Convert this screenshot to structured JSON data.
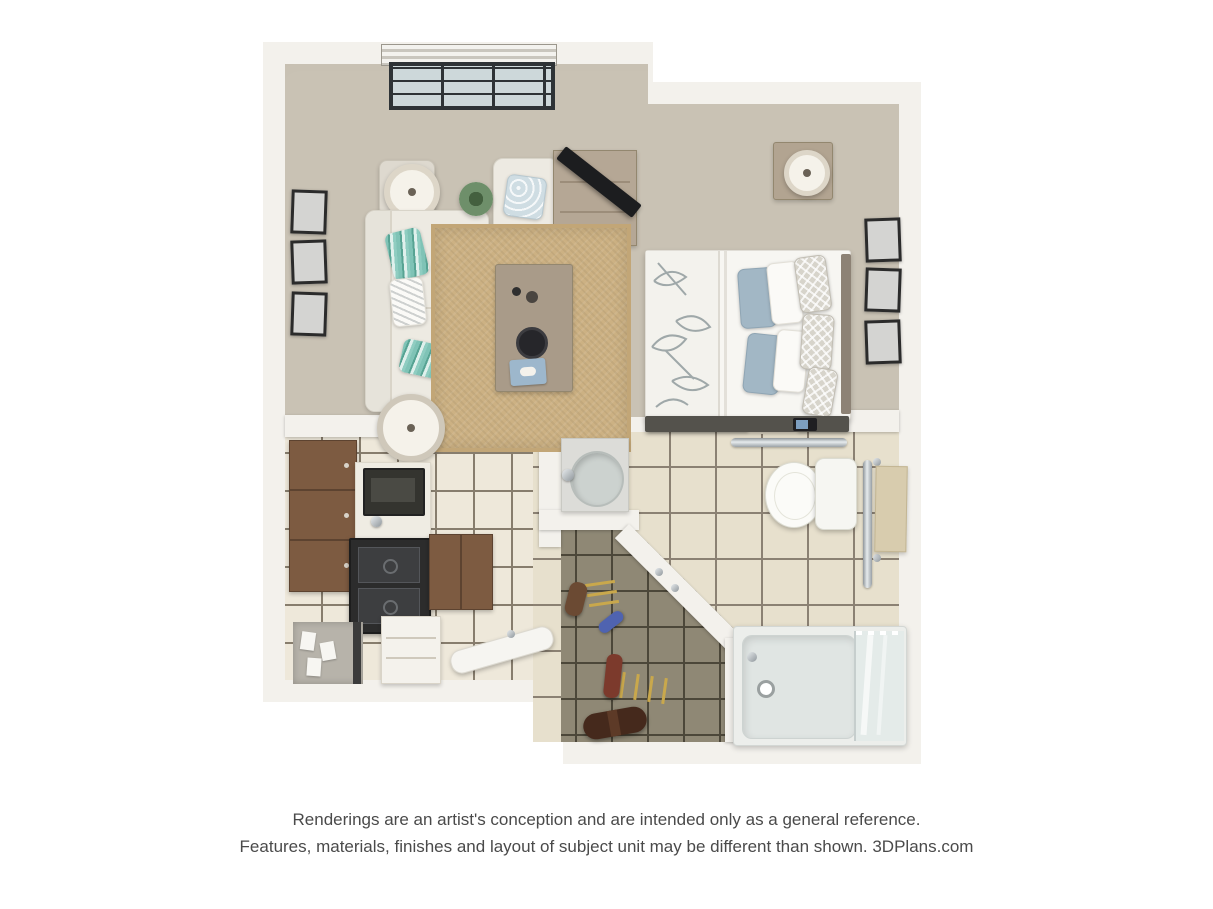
{
  "palette": {
    "background": "#ffffff",
    "wall": "#f3f1ec",
    "carpet": "#c9c2b4",
    "rug": "#ccb183",
    "kitchen_tile": "#eee8da",
    "kitchen_grout": "#877d6d",
    "bath_tile": "#e7e0cd",
    "bath_grout": "#8b8173",
    "closet_tile": "#8f8875",
    "closet_grout": "#4c4739",
    "cabinet_brown": "#7d5b41",
    "sofa_cream": "#edeae2",
    "teal_pillow": "#7fc3b6",
    "blue_pillow": "#a2b7c5",
    "wood": "#ab9d8b",
    "charcoal": "#3a3a3a",
    "chrome": "#b9bfc3",
    "text_gray": "#4a4a4a"
  },
  "disclaimer": {
    "line1": "Renderings are an artist's conception and are intended only as a general reference.",
    "line2": "Features, materials, finishes and layout of subject unit may be different than shown. 3DPlans.com"
  },
  "scene": {
    "type": "3d-floor-plan",
    "subject": "studio apartment top-down rendering",
    "rooms": [
      {
        "name": "living-area",
        "floor": "carpet",
        "items": [
          "window-with-blinds",
          "gallery-wall-three-frames",
          "table-lamp",
          "side-table",
          "sofa",
          "teal-striped-pillows",
          "armchair",
          "potted-plant",
          "tv-console",
          "television",
          "jute-rug",
          "coffee-table",
          "decor-bowl",
          "book-tray",
          "floor-lamp"
        ]
      },
      {
        "name": "sleeping-area",
        "floor": "carpet",
        "items": [
          "bed-leaf-print-duvet",
          "blue-pillows",
          "white-pillows",
          "patterned-pillows",
          "headboard",
          "foot-bench",
          "tablet",
          "nightstand",
          "nightstand-lamp",
          "gallery-wall-three-frames"
        ]
      },
      {
        "name": "kitchen",
        "floor": "light-tile",
        "items": [
          "upper-cabinets",
          "counter",
          "microwave",
          "faucet",
          "range",
          "base-cabinet",
          "drawer-dresser",
          "desk-nook-with-papers",
          "ironing-board"
        ]
      },
      {
        "name": "bathroom",
        "floor": "beige-tile",
        "items": [
          "marble-vanity-sink",
          "toilet",
          "grab-bar-top",
          "grab-bar-side",
          "towel-rail",
          "bathtub",
          "glass-shower-panel"
        ]
      },
      {
        "name": "entry-closet",
        "floor": "dark-tile",
        "items": [
          "angled-wall",
          "wall-hooks",
          "boot",
          "blue-slipper",
          "hanging-towel",
          "duffel-bag",
          "wood-slats"
        ]
      }
    ]
  }
}
